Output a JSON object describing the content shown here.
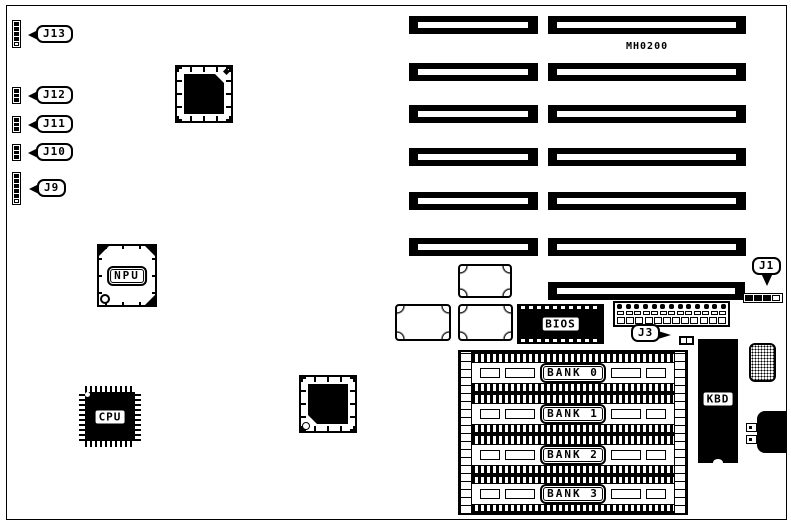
{
  "board": {
    "id": "MH0200"
  },
  "callouts": {
    "j13": "J13",
    "j12": "J12",
    "j11": "J11",
    "j10": "J10",
    "j9": "J9",
    "j1": "J1",
    "j3": "J3"
  },
  "chips": {
    "npu": "NPU",
    "cpu": "CPU",
    "bios": "BIOS",
    "kbd": "KBD"
  },
  "memory": {
    "banks": [
      {
        "label": "BANK 0"
      },
      {
        "label": "BANK 1"
      },
      {
        "label": "BANK 2"
      },
      {
        "label": "BANK 3"
      }
    ]
  },
  "slots": {
    "short_left_count": 6,
    "long_right_count": 7
  },
  "connector_pins": {
    "berg_dots": 13,
    "berg_mid": 13,
    "berg_squares": 12
  },
  "colors": {
    "ink": "#000000",
    "paper": "#ffffff"
  }
}
